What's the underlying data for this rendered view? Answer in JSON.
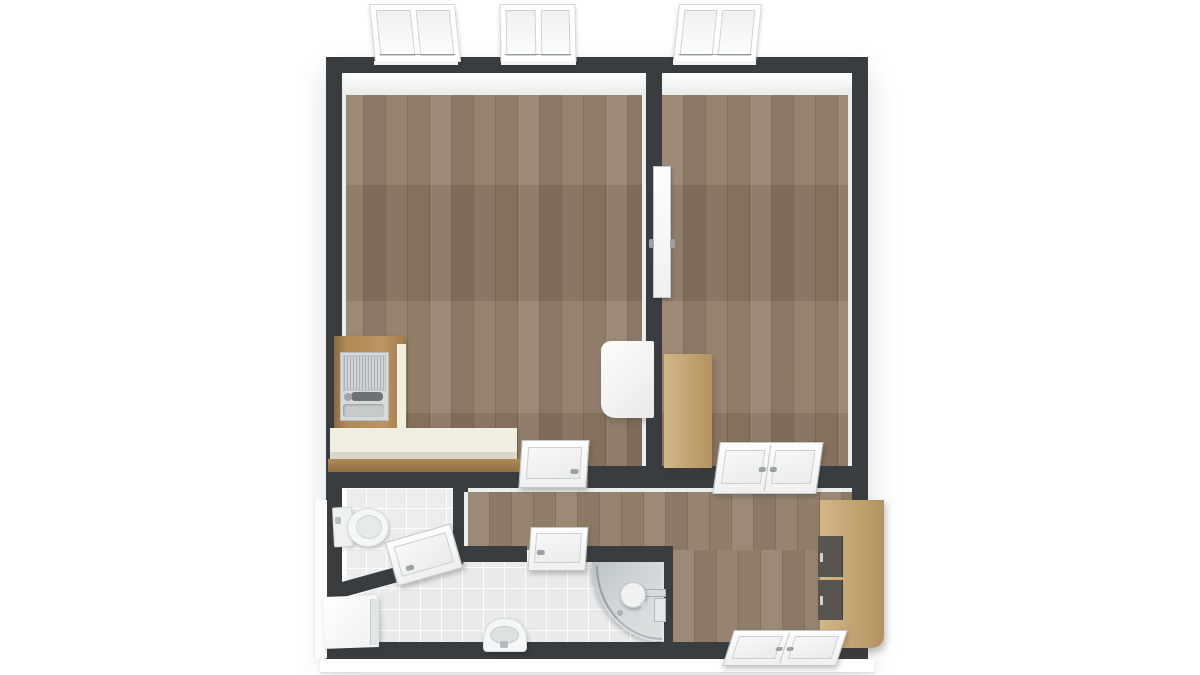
{
  "scene": {
    "type": "floor-plan-3d-render",
    "view": "top-down",
    "background": "#ffffff"
  },
  "palette": {
    "wall": "#3a3d40",
    "inner_face": "#eceded",
    "wood": "#8e7963",
    "tile": "#e8eaeb",
    "tile_wc": "#ebedee",
    "counter_top": "#f0efe1",
    "counter_face": "#d8d7c6",
    "counter_wood": "#b18a58",
    "steel": "#d7dadb",
    "steel_dark": "#6f7274",
    "furniture_tan": "#d3b787",
    "furniture_tan_dark": "#b29260",
    "drawer_front": "#58544f",
    "fixture_white": "#f4f6f7",
    "fixture_gray": "#cfd4d6",
    "shower_glass": "#c7ced2",
    "door_white": "#fbfbfc",
    "door_line": "#c5c8c9",
    "handle_gray": "#9da1a3",
    "slab_edge": "#e0e0e0"
  },
  "rooms": [
    {
      "id": "living-room",
      "floor": "hardwood",
      "features": [
        "l-shaped-kitchen-counter",
        "kitchen-sink-unit",
        "white-cabinet"
      ]
    },
    {
      "id": "bedroom",
      "floor": "hardwood",
      "features": [
        "wardrobe"
      ]
    },
    {
      "id": "hallway",
      "floor": "hardwood",
      "features": [
        "wardrobe-with-drawers"
      ]
    },
    {
      "id": "bathroom",
      "floor": "tile",
      "features": [
        "washing-machine",
        "washbasin",
        "corner-shower"
      ]
    },
    {
      "id": "wc",
      "floor": "tile",
      "features": [
        "toilet"
      ]
    }
  ],
  "openings": {
    "windows": [
      {
        "id": "window-1",
        "wall": "north",
        "room": "living-room",
        "panes": 2
      },
      {
        "id": "window-2",
        "wall": "north",
        "room": "living-room",
        "panes": 2
      },
      {
        "id": "window-3",
        "wall": "north",
        "room": "bedroom",
        "panes": 2
      }
    ],
    "doors": [
      {
        "id": "door-living-hall",
        "type": "single"
      },
      {
        "id": "door-living-bedroom",
        "type": "single"
      },
      {
        "id": "door-bedroom-hall",
        "type": "double"
      },
      {
        "id": "door-bathroom-hall",
        "type": "single"
      },
      {
        "id": "door-wc-bathroom",
        "type": "single"
      },
      {
        "id": "door-entry",
        "type": "double"
      }
    ]
  }
}
